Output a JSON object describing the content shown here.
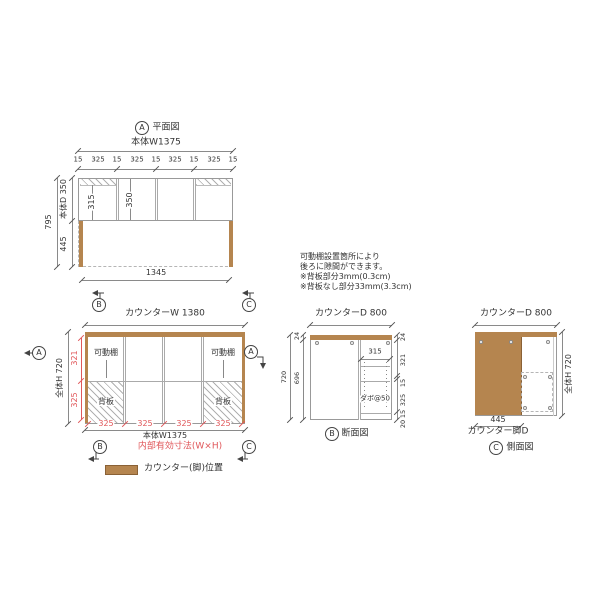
{
  "colors": {
    "wood": "#b5854f",
    "wood_edge": "#8a6135",
    "red": "#e0575a",
    "line": "#8a8a8a"
  },
  "plan": {
    "badge": "A",
    "title": "平面図",
    "width_label": "本体W1375",
    "top_dims": [
      "15",
      "325",
      "15",
      "325",
      "15",
      "325",
      "15",
      "325",
      "15"
    ],
    "inner_dim_1": "315",
    "inner_dim_2": "350",
    "depth_label": "本体D 350",
    "front_depth": "445",
    "total_depth": "795",
    "bottom_dim": "1345",
    "marker_b": "B",
    "marker_c": "C"
  },
  "front": {
    "counter_width_label": "カウンターW 1380",
    "height_label": "全体H 720",
    "upper_inner_height": "321",
    "lower_inner_height": "325",
    "shelf_label": "可動棚",
    "back_panel_label": "背板",
    "bottom_dims": [
      "325",
      "325",
      "325",
      "325"
    ],
    "body_width_label": "本体W1375",
    "inner_note": "内部有効寸法(W×H)",
    "marker_a": "A",
    "marker_b": "B",
    "marker_c": "C",
    "legend_label": "カウンター(脚)位置"
  },
  "notes": {
    "line1": "可動棚設置箇所により",
    "line2": "後ろに隙間ができます。",
    "line3": "※背板部分3mm(0.3cm)",
    "line4": "※背板なし部分33mm(3.3cm)"
  },
  "section": {
    "badge": "B",
    "title": "断面図",
    "depth_label": "カウンターD 800",
    "total_height": "720",
    "top_thickness": "24",
    "body_height": "696",
    "right_dims": [
      "24",
      "321",
      "15",
      "325",
      "15",
      "20"
    ],
    "inner_width": "315",
    "dowel_label": "ダボ@50"
  },
  "side": {
    "badge": "C",
    "title": "側面図",
    "depth_label": "カウンターD 800",
    "height_label": "全体H 720",
    "leg_depth": "445",
    "leg_label": "カウンター脚D"
  }
}
